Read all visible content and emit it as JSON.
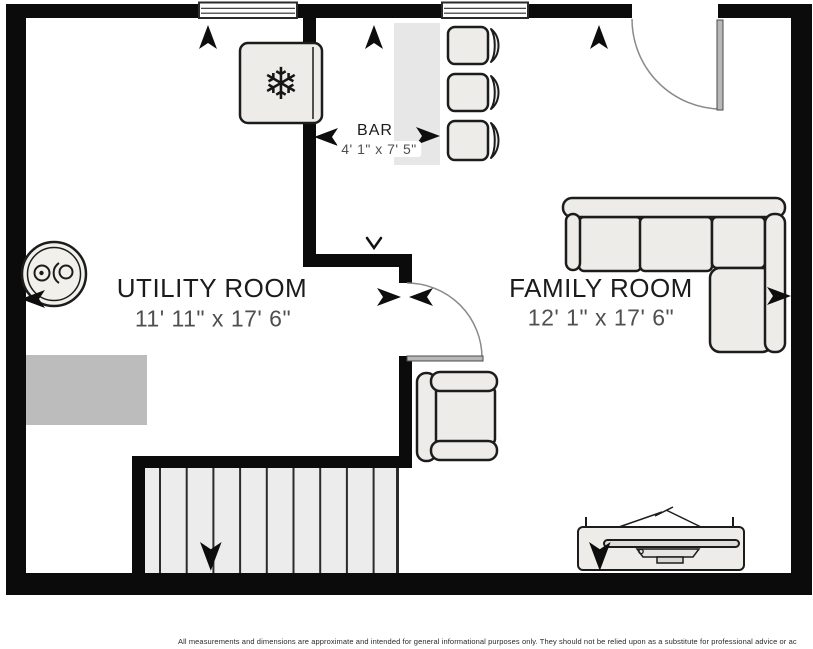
{
  "plan": {
    "rooms": {
      "utility": {
        "name": "UTILITY ROOM",
        "dimensions": "11' 11\" x 17' 6\""
      },
      "family": {
        "name": "FAMILY ROOM",
        "dimensions": "12' 1\" x 17' 6\""
      },
      "bar": {
        "name": "BAR",
        "dimensions": "4' 1\" x 7' 5\""
      }
    },
    "symbols": {
      "snowflake": "❄",
      "stairs_tread_count": 10,
      "bar_stool_count": 3,
      "window_count": 2,
      "door_count": 2,
      "arrows": [
        "up",
        "up",
        "up",
        "left",
        "right",
        "down-small",
        "right",
        "left",
        "left",
        "right",
        "down",
        "down"
      ]
    },
    "colors": {
      "wall": "#0b0b0b",
      "floor": "#ffffff",
      "furniture_fill": "#edece8",
      "furniture_outline": "#1c1c1c",
      "bar_counter": "#e7e7e7",
      "storage_block": "#bcbcbc",
      "stairs_fill": "#ececec",
      "stairs_line": "#2b2b2b",
      "door_leaf": "#b8b8b8",
      "swing_arc": "#8a8a8a",
      "room_name_text": "#1b1b1b",
      "dimension_text": "#4f4f4f"
    }
  },
  "footer": {
    "disclaimer": "All measurements and dimensions are approximate and intended for general informational purposes only. They should not be relied upon as a substitute for professional advice or ac"
  }
}
